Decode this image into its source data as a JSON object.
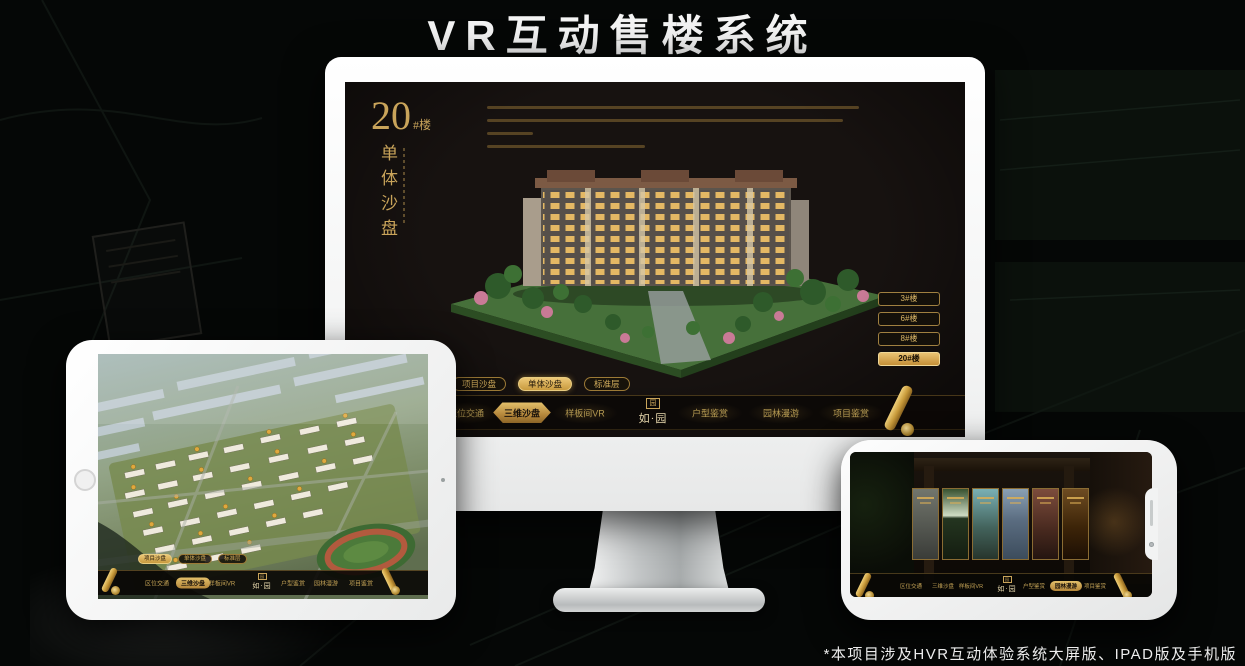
{
  "page": {
    "title": "VR互动售楼系统",
    "footnote": "*本项目涉及HVR互动体验系统大屏版、IPAD版及手机版"
  },
  "colors": {
    "gold": "#c9a45a",
    "gold_active": "#d9b364",
    "screen_bg": "#171210",
    "device_frame": "#f2f3f3"
  },
  "monitor_screen": {
    "block_number": "20",
    "block_suffix": "#楼",
    "block_subtitle": "单体沙盘",
    "floor_buttons": [
      {
        "label": "3#楼",
        "active": false
      },
      {
        "label": "6#楼",
        "active": false
      },
      {
        "label": "8#楼",
        "active": false
      },
      {
        "label": "20#楼",
        "active": true
      }
    ],
    "sub_tabs": [
      {
        "label": "项目沙盘",
        "active": false
      },
      {
        "label": "单体沙盘",
        "active": true
      },
      {
        "label": "标准层",
        "active": false
      }
    ],
    "nav": {
      "logo": "如·园",
      "logo_seal": "园",
      "items": [
        {
          "label": "区位交通",
          "active": false
        },
        {
          "label": "三维沙盘",
          "active": true
        },
        {
          "label": "样板间VR",
          "active": false
        },
        {
          "label": "户型鉴赏",
          "active": false
        },
        {
          "label": "园林漫游",
          "active": false
        },
        {
          "label": "项目鉴赏",
          "active": false
        }
      ]
    }
  },
  "ipad_screen": {
    "sub_tabs": [
      {
        "label": "项目沙盘",
        "active": true
      },
      {
        "label": "单体沙盘",
        "active": false
      },
      {
        "label": "标准层",
        "active": false
      }
    ],
    "nav": {
      "logo": "如·园",
      "logo_seal": "园",
      "items": [
        {
          "label": "区位交通",
          "active": false
        },
        {
          "label": "三维沙盘",
          "active": true
        },
        {
          "label": "样板间VR",
          "active": false
        },
        {
          "label": "户型鉴赏",
          "active": false
        },
        {
          "label": "园林漫游",
          "active": false
        },
        {
          "label": "项目鉴赏",
          "active": false
        }
      ]
    }
  },
  "phone_screen": {
    "nav": {
      "logo": "如·园",
      "logo_seal": "园",
      "items": [
        {
          "label": "区位交通",
          "active": false
        },
        {
          "label": "三维沙盘",
          "active": false
        },
        {
          "label": "样板间VR",
          "active": false
        },
        {
          "label": "户型鉴赏",
          "active": false
        },
        {
          "label": "园林漫游",
          "active": true
        },
        {
          "label": "项目鉴赏",
          "active": false
        }
      ]
    }
  }
}
